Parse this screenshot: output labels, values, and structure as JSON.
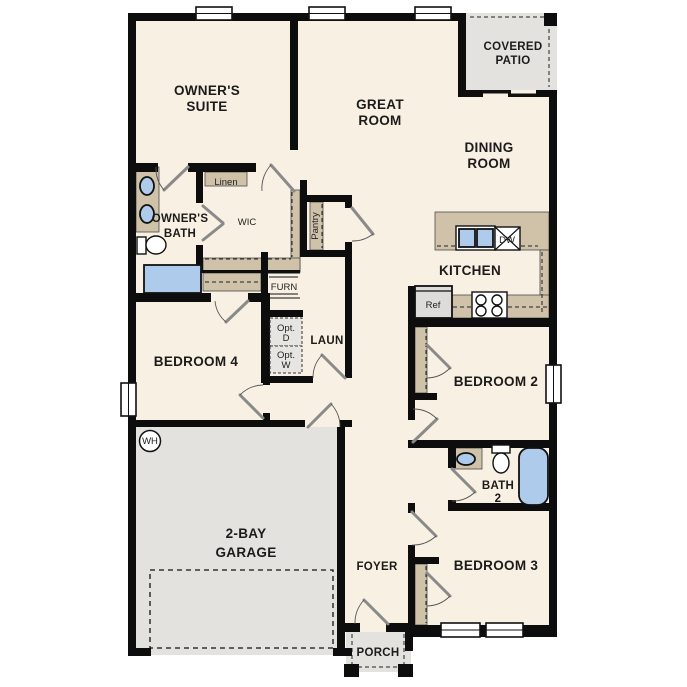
{
  "plan": {
    "type": "single-story floor plan",
    "colors": {
      "wall": "#0d0d0d",
      "floor": "#f8f0e2",
      "hard": "#e3e2df",
      "counter": "#cfc2a9",
      "blue": "#aecbec"
    },
    "rooms": {
      "owners_suite": {
        "line1": "OWNER'S",
        "line2": "SUITE"
      },
      "great_room": {
        "line1": "GREAT",
        "line2": "ROOM"
      },
      "covered_patio": {
        "line1": "COVERED",
        "line2": "PATIO"
      },
      "dining_room": {
        "line1": "DINING",
        "line2": "ROOM"
      },
      "owners_bath": {
        "line1": "OWNER'S",
        "line2": "BATH"
      },
      "kitchen": {
        "label": "KITCHEN"
      },
      "laundry": {
        "label": "LAUN"
      },
      "bedroom4": {
        "label": "BEDROOM 4"
      },
      "bedroom2": {
        "label": "BEDROOM 2"
      },
      "bath2": {
        "line1": "BATH",
        "line2": "2"
      },
      "bedroom3": {
        "label": "BEDROOM 3"
      },
      "garage": {
        "line1": "2-BAY",
        "line2": "GARAGE"
      },
      "foyer": {
        "label": "FOYER"
      },
      "porch": {
        "label": "PORCH"
      }
    },
    "features": {
      "linen": "Linen",
      "wic": "WIC",
      "pantry": "Pantry",
      "furnace": "FURN",
      "opt_dryer": {
        "line1": "Opt.",
        "line2": "D"
      },
      "opt_washer": {
        "line1": "Opt.",
        "line2": "W"
      },
      "refrigerator": "Ref",
      "dishwasher": "DW",
      "water_heater": "WH"
    }
  }
}
